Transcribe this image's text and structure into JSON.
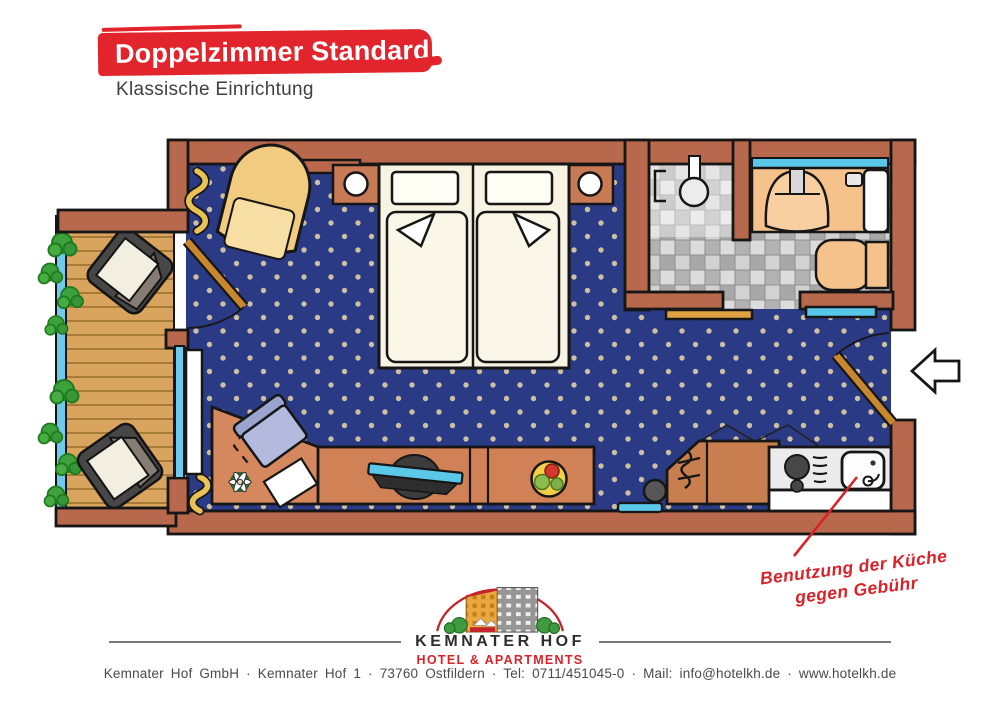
{
  "header": {
    "title": "Doppelzimmer Standard",
    "subtitle": "Klassische Einrichtung",
    "banner_color": "#e2242c"
  },
  "floorplan": {
    "annotation": {
      "line1": "Benutzung der Küche",
      "line2": "gegen Gebühr",
      "color": "#d8232a"
    },
    "colors": {
      "wall": "#b8684c",
      "carpet": "#2b3a84",
      "carpet_dot": "#cdc0a2",
      "balcony_deck": "#d9a45d",
      "railing": "#6fc9e9",
      "bath_tile": "#c4c4c4",
      "bath_fixture": "#f5c28c",
      "mirror_blue": "#58c7e9",
      "furniture_wood": "#d08155",
      "kitchen_counter": "#ebebeb",
      "accent_red": "#d8232a"
    },
    "elements": [
      "double-bed",
      "pillows",
      "nightstand-left",
      "nightstand-right",
      "bedside-lamps",
      "armchair",
      "curtains",
      "balcony-window",
      "balcony-door",
      "balcony-deck",
      "balcony-railing",
      "plants",
      "balcony-chairs",
      "corner-desk",
      "desk-chair",
      "paper",
      "flower-vase",
      "tv-sideboard",
      "tv",
      "fruit-bowl",
      "wardrobe",
      "clothes-rail",
      "trash-bin",
      "floor-mat",
      "kitchenette",
      "stove-burners",
      "kitchen-sink",
      "shower",
      "washbasin",
      "faucet",
      "soap-dish",
      "towel-radiator",
      "toilet",
      "wall-shelf",
      "bench-wood",
      "bench-blue",
      "entrance-door",
      "entrance-arrow"
    ]
  },
  "logo": {
    "name": "KEMNATER HOF",
    "tagline": "HOTEL & APARTMENTS",
    "name_color": "#2d2d2d",
    "tagline_color": "#d8232a"
  },
  "footer": {
    "text": "Kemnater Hof GmbH · Kemnater Hof 1 · 73760 Ostfildern · Tel: 0711/451045-0 · Mail: info@hotelkh.de · www.hotelkh.de"
  }
}
